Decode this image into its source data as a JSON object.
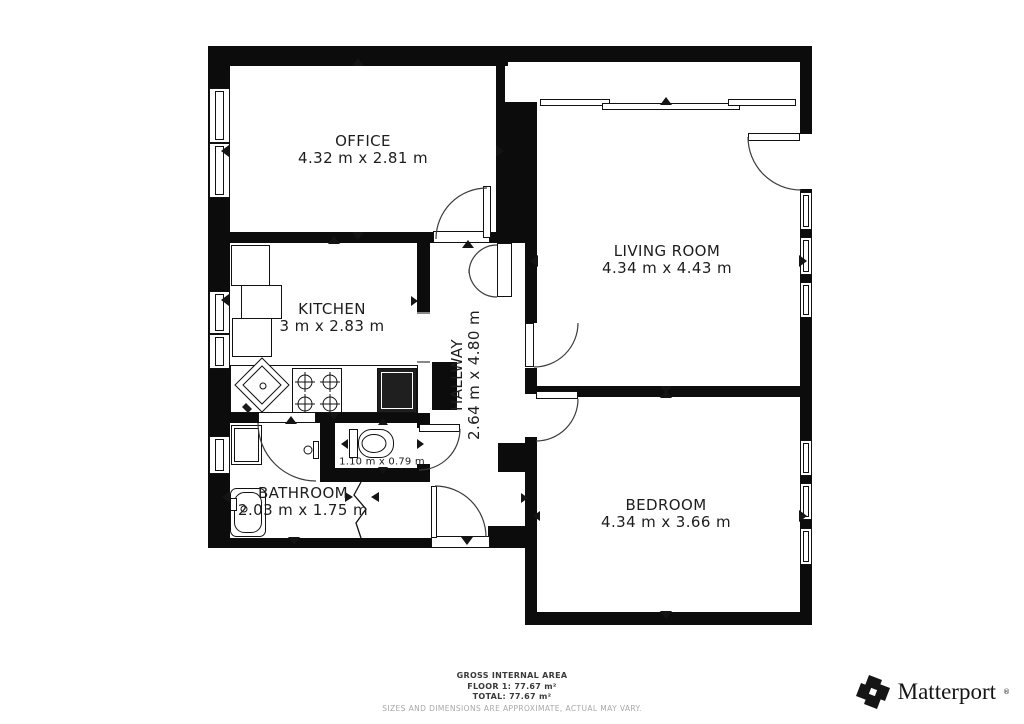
{
  "floorplan": {
    "rooms": [
      {
        "id": "office",
        "name": "OFFICE",
        "dims": "4.32 m x 2.81 m"
      },
      {
        "id": "living-room",
        "name": "LIVING ROOM",
        "dims": "4.34 m x 4.43 m"
      },
      {
        "id": "kitchen",
        "name": "KITCHEN",
        "dims": "3 m x 2.83 m"
      },
      {
        "id": "hallway",
        "name": "HALLWAY",
        "dims": "2.64 m x 4.80 m"
      },
      {
        "id": "bathroom",
        "name": "BATHROOM",
        "dims": "2.03 m x 1.75 m"
      },
      {
        "id": "bedroom",
        "name": "BEDROOM",
        "dims": "4.34 m x 3.66 m"
      },
      {
        "id": "wc",
        "name": "",
        "dims": "1.10 m x 0.79 m"
      }
    ],
    "wall_color": "#0c0c0c",
    "line_color": "#111111"
  },
  "footer": {
    "title": "GROSS INTERNAL AREA",
    "floor_line": "FLOOR 1: 77.67 m²",
    "total_line": "TOTAL: 77.67 m²",
    "disclaimer": "SIZES AND DIMENSIONS ARE APPROXIMATE, ACTUAL MAY VARY."
  },
  "branding": {
    "name": "Matterport",
    "trademark": "®"
  }
}
